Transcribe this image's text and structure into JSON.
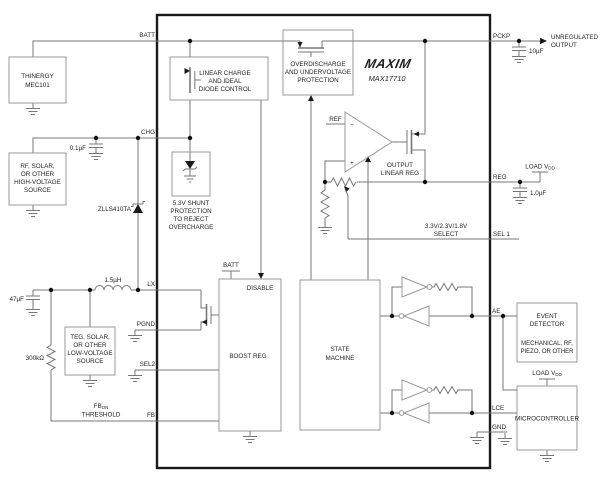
{
  "chip": {
    "brand": "MAXIM",
    "part": "MAX17710"
  },
  "pins": {
    "batt": "BATT",
    "chg": "CHG",
    "lx": "LX",
    "pgnd": "PGND",
    "sel2": "SEL2",
    "fb": "FB",
    "pckp": "PCKP",
    "reg": "REG",
    "sel1": "SEL 1",
    "ae": "AE",
    "lce": "LCE",
    "gnd": "GND"
  },
  "blocks": {
    "linear_charge": [
      "LINEAR CHARGE",
      "AND IDEAL",
      "DIODE CONTROL"
    ],
    "overdischarge": [
      "OVERDISCHARGE",
      "AND UNDERVOLTAGE",
      "PROTECTION"
    ],
    "shunt": [
      "5.3V SHUNT",
      "PROTECTION",
      "TO REJECT",
      "OVERCHARGE"
    ],
    "boost": {
      "label": "BOOST REG",
      "disable": "DISABLE",
      "batt_tap": "BATT"
    },
    "state_machine": [
      "STATE",
      "MACHINE"
    ],
    "linear_reg": {
      "label": [
        "OUTPUT",
        "LINEAR REG"
      ],
      "ref": "REF",
      "minus": "−",
      "plus": "+",
      "select": [
        "3.3V/2.3V/1.8V",
        "SELECT"
      ]
    }
  },
  "external": {
    "thinergy": [
      "THINERGY",
      "MEC101"
    ],
    "hv_source": [
      "RF, SOLAR,",
      "OR OTHER",
      "HIGH-VOLTAGE",
      "SOURCE"
    ],
    "lv_source": [
      "TEG, SOLAR,",
      "OR OTHER",
      "LOW-VOLTAGE",
      "SOURCE"
    ],
    "event_detector": [
      "EVENT",
      "DETECTOR"
    ],
    "event_detector_sub": [
      "MECHANICAL, RF,",
      "PIEZO, OR OTHER"
    ],
    "microcontroller": "MICROCONTROLLER",
    "unregulated": [
      "UNREGULATED",
      "OUTPUT"
    ]
  },
  "components": {
    "cap_chg": "0.1µF",
    "cap_in": "47µF",
    "cap_out": "10µF",
    "cap_reg": "1.0µF",
    "res_fb": "300kΩ",
    "inductor": "1.5µH",
    "diode": "ZLLS410TA"
  },
  "labels": {
    "load_vdd_main": "LOAD V",
    "load_vdd_sub": "DD",
    "fb_main": "FB",
    "fb_sub": "ON",
    "fb_line2": "THRESHOLD"
  },
  "colors": {
    "wire": "#777777",
    "box": "#999999",
    "chip_border": "#1a1a1a",
    "text": "#1f1f1f"
  }
}
